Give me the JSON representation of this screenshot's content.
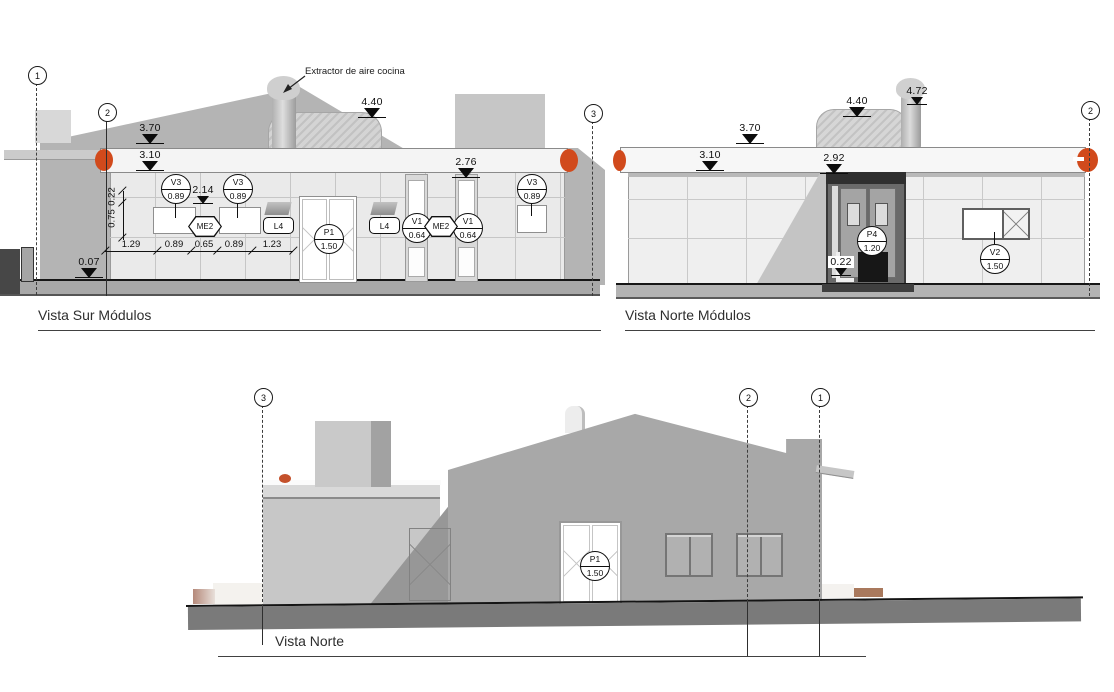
{
  "colors": {
    "accent_orange": "#d14a1c",
    "building_gray": "#a8a8a8"
  },
  "views": {
    "vista_sur": {
      "title": "Vista Sur Módulos",
      "note": "Extractor de aire cocina",
      "grids": [
        "1",
        "2",
        "3"
      ],
      "levels": [
        "3.70",
        "3.10",
        "4.40",
        "2.76",
        "2.14",
        "0.07"
      ],
      "tags": [
        {
          "code": "V3",
          "val": "0.89"
        },
        {
          "code": "V3",
          "val": "0.89"
        },
        {
          "code": "P1",
          "val": "1.50"
        },
        {
          "code": "V1",
          "val": "0.64"
        },
        {
          "code": "V1",
          "val": "0.64"
        },
        {
          "code": "V3",
          "val": "0.89"
        }
      ],
      "me_tags": [
        "ME2",
        "ME2"
      ],
      "l_labels": [
        "L4",
        "L4"
      ],
      "vdims": [
        "0.22",
        "0.75"
      ],
      "hdims": [
        "1.29",
        "0.89",
        "0.65",
        "0.89",
        "1.23"
      ]
    },
    "vista_norte_modulos": {
      "title": "Vista Norte Módulos",
      "grids": [
        "2"
      ],
      "levels": [
        "3.70",
        "3.10",
        "4.40",
        "4.72",
        "2.92",
        "0.22"
      ],
      "tags": [
        {
          "code": "P4",
          "val": "1.20"
        },
        {
          "code": "V2",
          "val": "1.50"
        }
      ]
    },
    "vista_norte": {
      "title": "Vista Norte",
      "grids": [
        "3",
        "2",
        "1"
      ],
      "tags": [
        {
          "code": "P1",
          "val": "1.50"
        }
      ]
    }
  }
}
